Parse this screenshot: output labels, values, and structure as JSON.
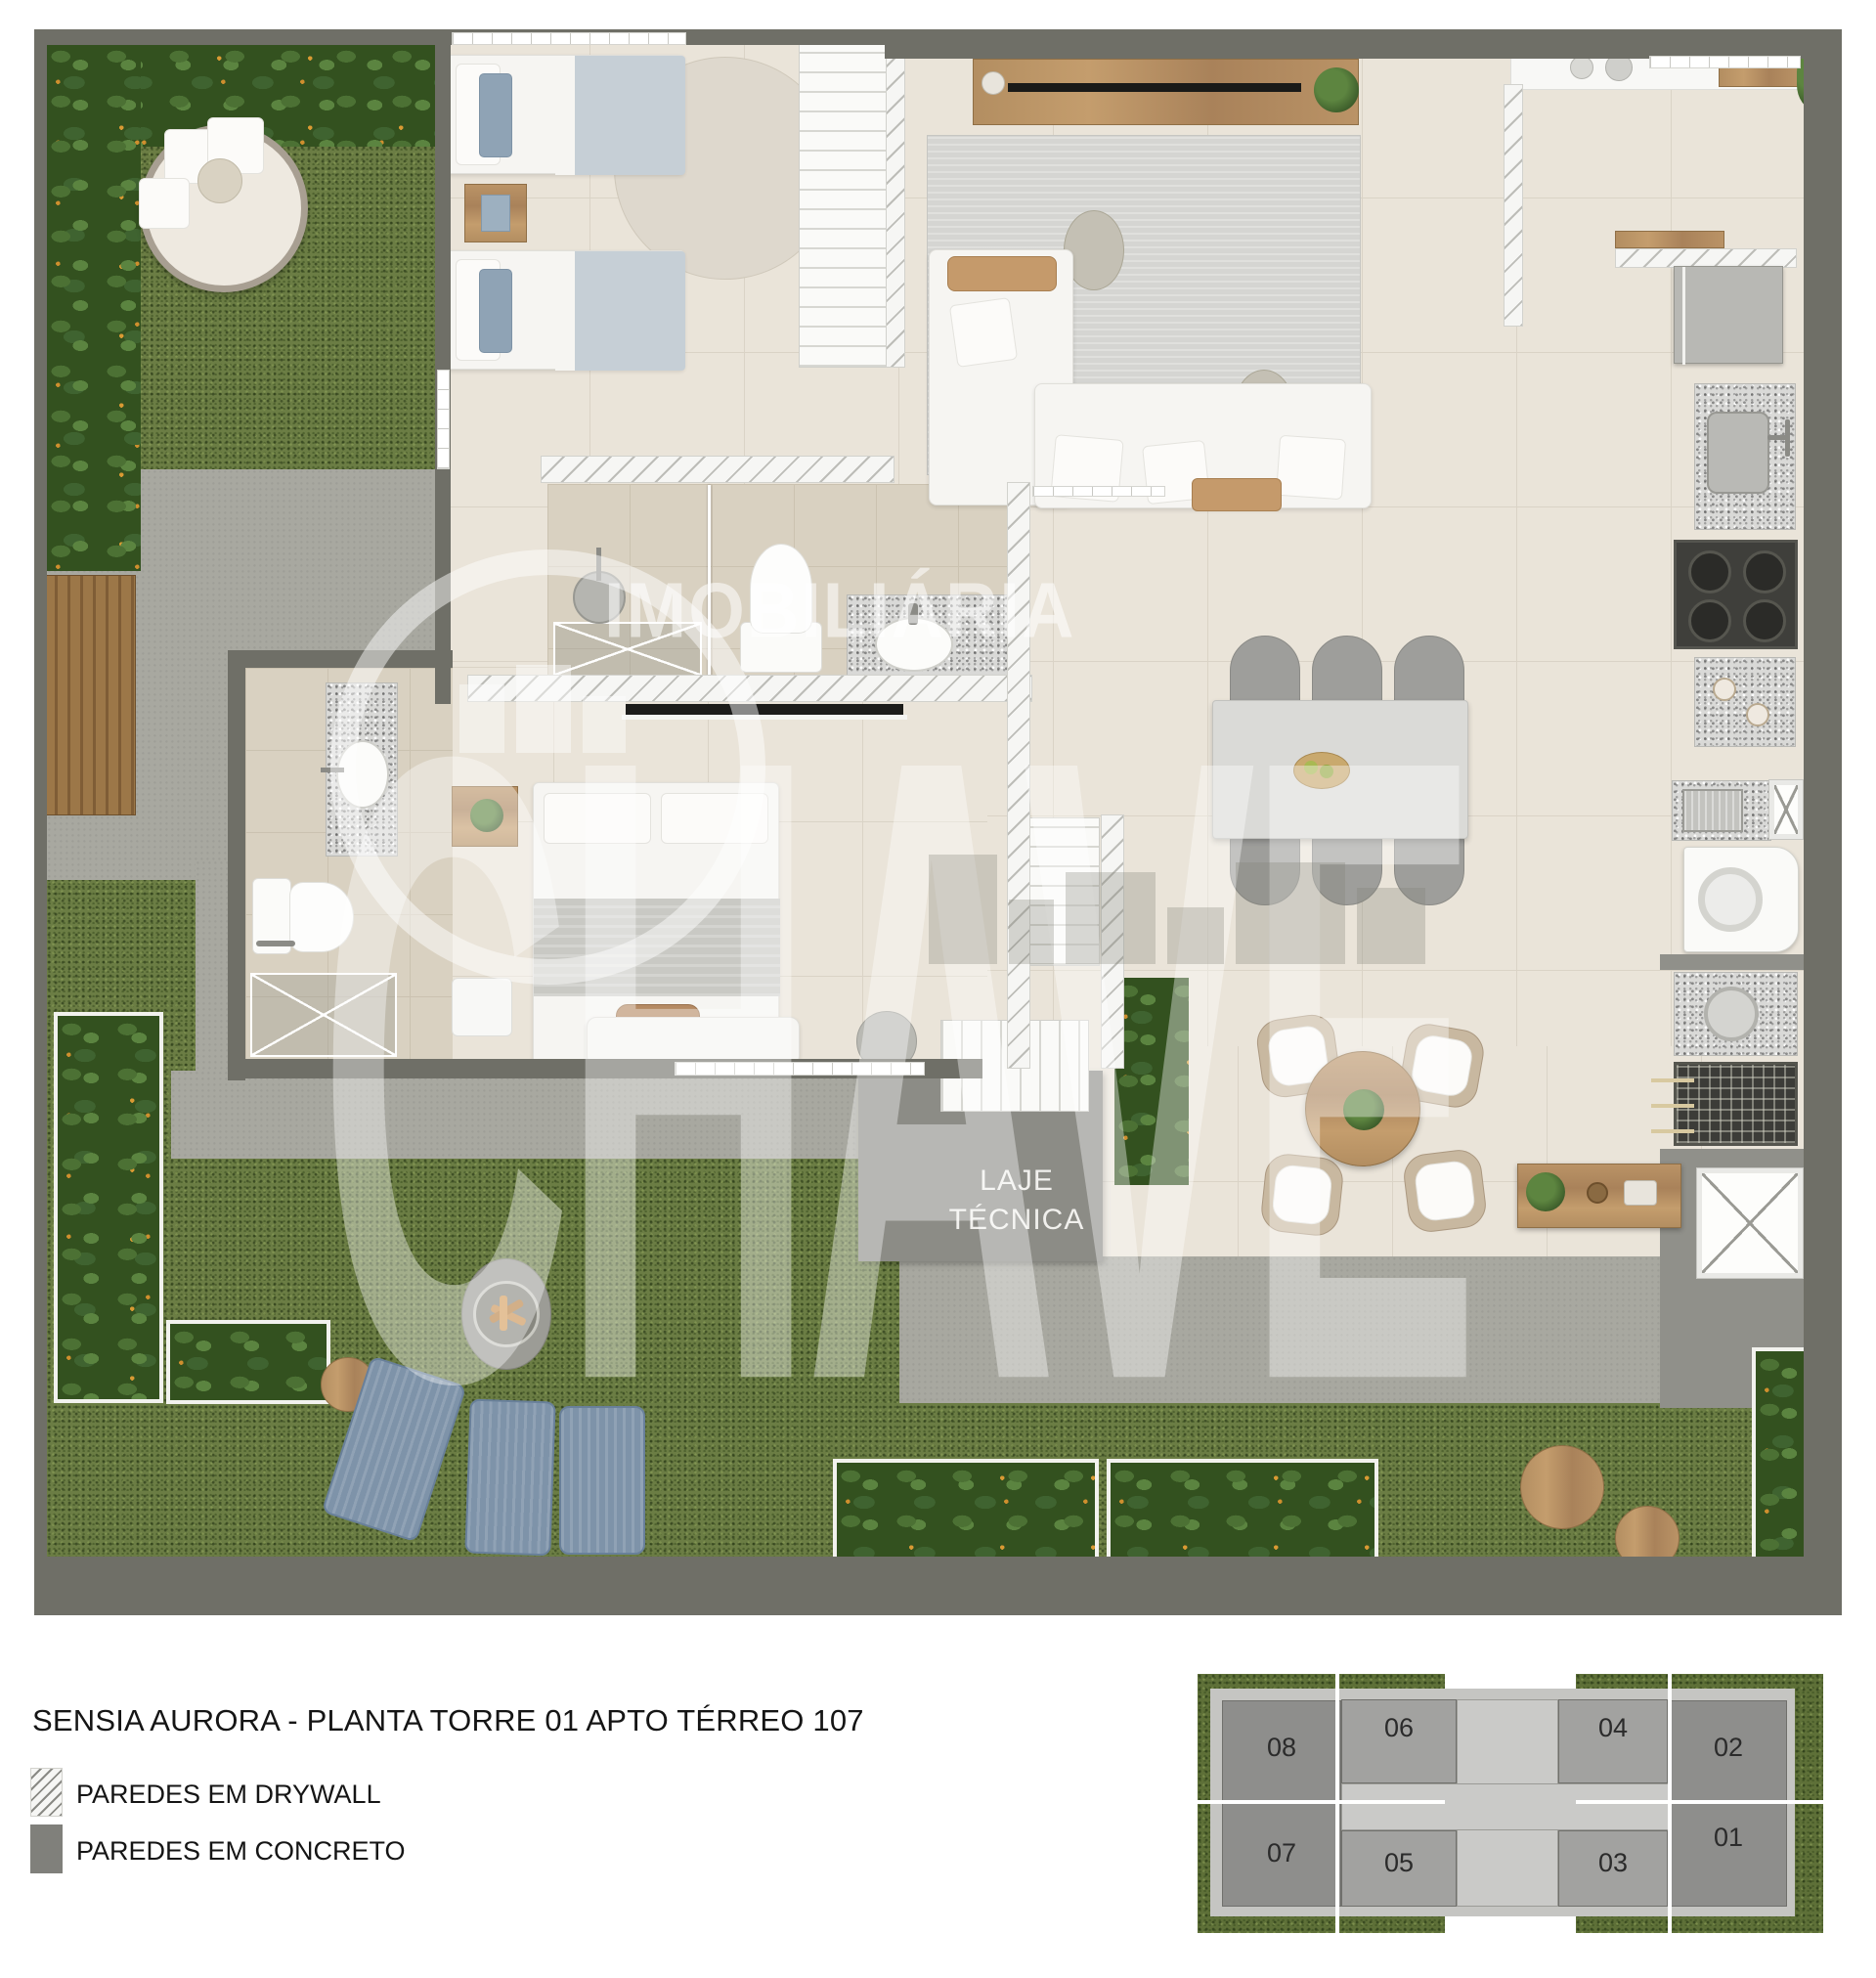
{
  "title": "SENSIA AURORA - PLANTA TORRE 01 APTO TÉRREO 107",
  "legend": {
    "items": [
      {
        "label": "PAREDES EM DRYWALL",
        "swatch": "drywall-hatch"
      },
      {
        "label": "PAREDES EM CONCRETO",
        "swatch": "concrete-solid"
      }
    ]
  },
  "plan": {
    "laje": {
      "line1": "LAJE",
      "line2": "TÉCNICA"
    }
  },
  "watermark": {
    "top": "IMOBILIÁRIA",
    "main": "CHAVE"
  },
  "keyplan": {
    "units": [
      {
        "id": "08"
      },
      {
        "id": "06"
      },
      {
        "id": "04"
      },
      {
        "id": "02"
      },
      {
        "id": "07"
      },
      {
        "id": "05"
      },
      {
        "id": "03"
      },
      {
        "id": "01"
      }
    ]
  },
  "colors": {
    "wall": "#6F6F67",
    "drywall": "#F6F6F4",
    "grass": "#6B7D44",
    "grassdark": "#5E7038",
    "concrete": "#A8A8A0",
    "concrete_dark": "#90908A",
    "indoor": "#EAE4D9",
    "tileline": "#DAD3C6",
    "bathfloor": "#D9D1C1",
    "granite": "#D9D9D7",
    "blue": "#7E93A9",
    "slab": "#8C8C86",
    "ink": "#151515"
  }
}
